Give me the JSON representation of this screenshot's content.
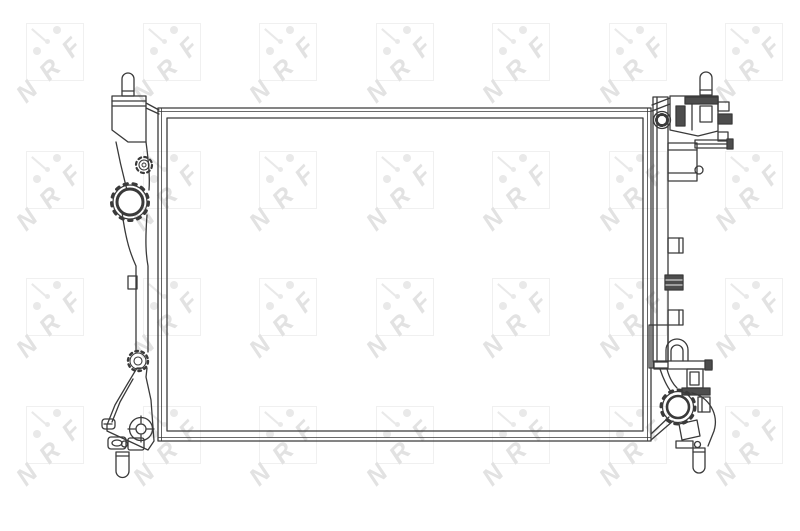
{
  "page": {
    "background_color": "#ffffff",
    "kind_label": "technical line drawing"
  },
  "watermark": {
    "text": "NRF",
    "letters": [
      "N",
      "R",
      "F"
    ],
    "square_color": "#f0f0f0",
    "letter_color": "#e2e2e2",
    "dot_color": "#e9e9e9"
  },
  "drawing": {
    "stroke_color": "#3a3a3a",
    "dark_fill_color": "#4d4d4d"
  }
}
